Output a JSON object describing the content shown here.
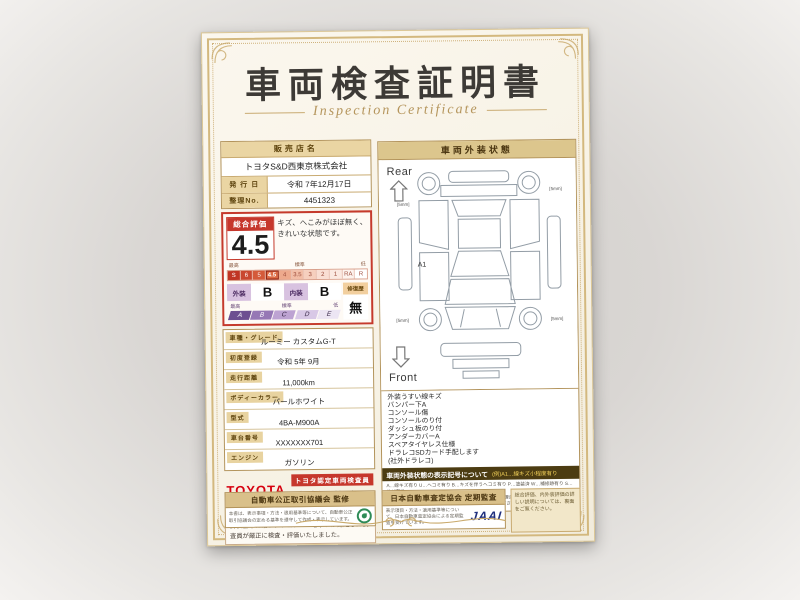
{
  "certificate": {
    "title": "車両検査証明書",
    "subtitle": "Inspection Certificate",
    "store": {
      "name_label": "販売店名",
      "name": "トヨタS&D西東京株式会社",
      "issue_label": "発 行 日",
      "issue_value": "令和 7年12月17日",
      "ref_label": "整理No.",
      "ref_value": "4451323"
    },
    "rating": {
      "label": "総合評価",
      "score": "4.5",
      "comment": "キズ、へこみがほぼ無く、きれいな状態です。",
      "scale_labels": {
        "high": "最高",
        "mid": "標準",
        "low": "低"
      },
      "scale": [
        "S",
        "6",
        "5",
        "4.5",
        "4",
        "3.5",
        "3",
        "2",
        "1",
        "RA",
        "R"
      ],
      "exterior_label": "外装",
      "exterior_grade": "B",
      "interior_label": "内装",
      "interior_grade": "B",
      "repair_label": "修復歴",
      "repair_value": "無",
      "letter_labels": {
        "high": "最高",
        "mid": "標準",
        "low": "低"
      },
      "letter_scale": [
        "A",
        "B",
        "C",
        "D",
        "E"
      ]
    },
    "info_rows": [
      {
        "label": "車種・グレード",
        "value": "ルーミー カスタムG-T"
      },
      {
        "label": "初度登録",
        "value": "令和 5年 9月"
      },
      {
        "label": "走行距離",
        "value": "11,000km"
      },
      {
        "label": "ボディーカラー",
        "value": "パールホワイト"
      },
      {
        "label": "型式",
        "value": "4BA-M900A"
      },
      {
        "label": "車台番号",
        "value": "XXXXXXX701"
      },
      {
        "label": "エンジン",
        "value": "ガソリン"
      }
    ],
    "inspector": {
      "brand": "TOYOTA",
      "cert_label": "トヨタ認定車両検査員",
      "name": "高橋 英之"
    },
    "note": "当車両は、自動車オークションで適用される車両評価基準に沿い、トヨタユーゼックが認定した検査員が厳正に検査・評価いたしました。",
    "exterior_panel": {
      "title": "車両外装状態",
      "rear_label": "Rear",
      "front_label": "Front",
      "marker": "A1",
      "tire_note": "[5mm]",
      "findings": [
        "外装うすい線キズ",
        "バンパー下A",
        "コンソール傷",
        "コンソールのり付",
        "ダッシュ板のり付",
        "アンダーカバーA",
        "スペアタイヤレス仕様",
        "ドラレコSDカード手配します",
        "(社外ドラレコ)"
      ],
      "legend_title": "車両外装状態の表示記号について",
      "legend_example": "(例)A1…線キズ小程度有り",
      "legend_lines": [
        "A…線キズ有り U…ヘコミ有り B…キズを伴うヘコミ有り P…塗装済 W…補修跡有り S…サビ有り",
        "C…腐食有り G…フロントガラスキズ有り X…要交換(修理含む) XX…交換済有り",
        "1…小程度 2…中程度 3…中程度以上 ※タイヤ残り溝の深さを表示しています"
      ]
    },
    "footer": {
      "fair_trade_title": "自動車公正取引協議会 監修",
      "fair_trade_body": "本書は、表示事項・方法・適用基準等について、自動車公正取引協議会の定める基準を遵守して作成・表示しています。",
      "jaai_title": "日本自動車査定協会 定期監査",
      "jaai_body": "表示項目・方法・適用基準等について、日本自動車査定協会による定期監査を受けています。",
      "jaai_logo": "JAAI",
      "back_note": "総合評価、内外装評価の詳しい説明については、裏面をご覧ください。"
    }
  }
}
